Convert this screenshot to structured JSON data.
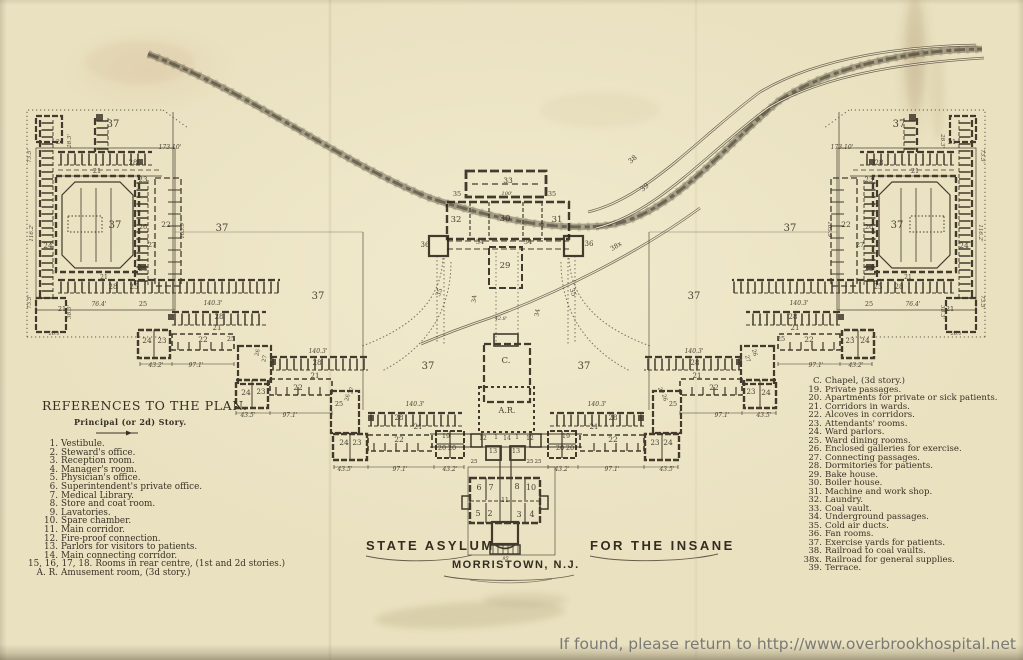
{
  "colors": {
    "paper": "#e9e1c0",
    "ink": "#2b2418",
    "label": "#3a3226",
    "watermark": "#6f6f6f"
  },
  "title_block": {
    "left": "STATE ASYLUM",
    "right": "FOR THE INSANE",
    "city": "MORRISTOWN, N.J."
  },
  "references": {
    "heading": "REFERENCES TO THE PLAN.",
    "subheading": "Principal (or 2d) Story.",
    "left_items": [
      {
        "n": "1.",
        "t": "Vestibule."
      },
      {
        "n": "2.",
        "t": "Steward's office."
      },
      {
        "n": "3.",
        "t": "Reception room."
      },
      {
        "n": "4.",
        "t": "Manager's room."
      },
      {
        "n": "5.",
        "t": "Physician's office."
      },
      {
        "n": "6.",
        "t": "Superintendent's private office."
      },
      {
        "n": "7.",
        "t": "Medical Library."
      },
      {
        "n": "8.",
        "t": "Store and coat room."
      },
      {
        "n": "9.",
        "t": "Lavatories."
      },
      {
        "n": "10.",
        "t": "Spare chamber."
      },
      {
        "n": "11.",
        "t": "Main corridor."
      },
      {
        "n": "12.",
        "t": "Fire-proof connection."
      },
      {
        "n": "13.",
        "t": "Parlors for visitors to patients."
      },
      {
        "n": "14.",
        "t": "Main connecting corridor."
      },
      {
        "n": "15, 16, 17, 18.",
        "t": "Rooms in rear centre, (1st and 2d stories.)"
      },
      {
        "n": "A. R.",
        "t": "Amusement room, (3d story.)"
      }
    ],
    "right_items": [
      {
        "n": "C.",
        "t": "Chapel, (3d story.)"
      },
      {
        "n": "19.",
        "t": "Private passages."
      },
      {
        "n": "20.",
        "t": "Apartments for private or sick patients."
      },
      {
        "n": "21.",
        "t": "Corridors in wards."
      },
      {
        "n": "22.",
        "t": "Alcoves in corridors."
      },
      {
        "n": "23.",
        "t": "Attendants' rooms."
      },
      {
        "n": "24.",
        "t": "Ward parlors."
      },
      {
        "n": "25.",
        "t": "Ward dining rooms."
      },
      {
        "n": "26.",
        "t": "Enclosed galleries for exercise."
      },
      {
        "n": "27.",
        "t": "Connecting passages."
      },
      {
        "n": "28.",
        "t": "Dormitories for patients."
      },
      {
        "n": "29.",
        "t": "Bake house."
      },
      {
        "n": "30.",
        "t": "Boiler house."
      },
      {
        "n": "31.",
        "t": "Machine and work shop."
      },
      {
        "n": "32.",
        "t": "Laundry."
      },
      {
        "n": "33.",
        "t": "Coal vault."
      },
      {
        "n": "34.",
        "t": "Underground passages."
      },
      {
        "n": "35.",
        "t": "Cold air ducts."
      },
      {
        "n": "36.",
        "t": "Fan rooms."
      },
      {
        "n": "37.",
        "t": "Exercise yards for patients."
      },
      {
        "n": "38.",
        "t": "Railroad to coal vaults."
      },
      {
        "n": "38x.",
        "t": "Railroad for general supplies."
      },
      {
        "n": "39.",
        "t": "Terrace."
      }
    ]
  },
  "watermark": "If found, please return to http://www.overbrookhospital.net",
  "plan_labels": [
    {
      "t": "37",
      "x": 113,
      "y": 127,
      "s": 10,
      "m": 1
    },
    {
      "t": "37",
      "x": 115,
      "y": 228,
      "s": 10,
      "m": 1
    },
    {
      "t": "37",
      "x": 222,
      "y": 231,
      "s": 10,
      "m": 1
    },
    {
      "t": "37",
      "x": 318,
      "y": 299,
      "s": 10,
      "m": 1
    },
    {
      "t": "37",
      "x": 428,
      "y": 369,
      "s": 10,
      "m": 1
    },
    {
      "t": "173.10'",
      "x": 170,
      "y": 149,
      "s": 6,
      "m": 1
    },
    {
      "t": "28.3'",
      "x": 71,
      "y": 141,
      "s": 5.5,
      "r": -90,
      "m": 1
    },
    {
      "t": "21",
      "x": 60,
      "y": 144,
      "s": 6.5,
      "m": 1
    },
    {
      "t": "28",
      "x": 133,
      "y": 165,
      "s": 7,
      "m": 1
    },
    {
      "t": "21",
      "x": 97,
      "y": 173,
      "s": 6.5,
      "m": 1
    },
    {
      "t": "23",
      "x": 143,
      "y": 182,
      "s": 7,
      "m": 1
    },
    {
      "t": "26",
      "x": 143,
      "y": 229,
      "s": 6.5,
      "m": 1
    },
    {
      "t": "22",
      "x": 166,
      "y": 227,
      "s": 7.5,
      "m": 1
    },
    {
      "t": "27",
      "x": 152,
      "y": 247,
      "s": 6.5,
      "m": 1
    },
    {
      "t": "23",
      "x": 143,
      "y": 271,
      "s": 7,
      "m": 1
    },
    {
      "t": "24",
      "x": 48,
      "y": 248,
      "s": 7.5,
      "m": 1
    },
    {
      "t": "21",
      "x": 104,
      "y": 279,
      "s": 6,
      "m": 1
    },
    {
      "t": "28",
      "x": 113,
      "y": 289,
      "s": 7,
      "m": 1
    },
    {
      "t": "25",
      "x": 134,
      "y": 289,
      "s": 7,
      "m": 1
    },
    {
      "t": "21",
      "x": 62,
      "y": 311,
      "s": 6.5,
      "m": 1
    },
    {
      "t": "73.5'",
      "x": 31,
      "y": 156,
      "s": 5.5,
      "r": -90,
      "m": 1
    },
    {
      "t": "116.2'",
      "x": 33,
      "y": 233,
      "s": 5.5,
      "r": -90,
      "m": 1
    },
    {
      "t": "73.5'",
      "x": 31,
      "y": 302,
      "s": 5.5,
      "r": -90,
      "m": 1
    },
    {
      "t": "105.9'",
      "x": 184,
      "y": 230,
      "s": 5.5,
      "r": -90,
      "m": 1
    },
    {
      "t": "38.3'",
      "x": 71,
      "y": 312,
      "s": 5.5,
      "r": -90,
      "m": 1
    },
    {
      "t": "76.4'",
      "x": 99,
      "y": 306,
      "s": 6,
      "m": 1
    },
    {
      "t": "26.1'",
      "x": 55,
      "y": 335,
      "s": 5,
      "m": 1
    },
    {
      "t": "25",
      "x": 143,
      "y": 306,
      "s": 6.5,
      "m": 1
    },
    {
      "t": "140.3'",
      "x": 213,
      "y": 305,
      "s": 6,
      "m": 1
    },
    {
      "t": "28",
      "x": 219,
      "y": 319,
      "s": 7,
      "m": 1
    },
    {
      "t": "21",
      "x": 217,
      "y": 330,
      "s": 7,
      "m": 1
    },
    {
      "t": "24",
      "x": 147,
      "y": 343,
      "s": 7.5,
      "m": 1
    },
    {
      "t": "23",
      "x": 162,
      "y": 343,
      "s": 7,
      "m": 1
    },
    {
      "t": "22",
      "x": 203,
      "y": 342,
      "s": 7.5,
      "m": 1
    },
    {
      "t": "25",
      "x": 231,
      "y": 341,
      "s": 6.5,
      "m": 1
    },
    {
      "t": "43.2'",
      "x": 156,
      "y": 367,
      "s": 6,
      "m": 1
    },
    {
      "t": "97.1'",
      "x": 196,
      "y": 367,
      "s": 6,
      "m": 1
    },
    {
      "t": "26",
      "x": 259,
      "y": 353,
      "s": 5.5,
      "r": -75,
      "m": 1
    },
    {
      "t": "27",
      "x": 266,
      "y": 359,
      "s": 5.5,
      "r": -75,
      "m": 1
    },
    {
      "t": "140.3'",
      "x": 318,
      "y": 353,
      "s": 6,
      "m": 1
    },
    {
      "t": "28",
      "x": 317,
      "y": 365,
      "s": 7,
      "m": 1
    },
    {
      "t": "21",
      "x": 315,
      "y": 378,
      "s": 7,
      "m": 1
    },
    {
      "t": "24",
      "x": 246,
      "y": 395,
      "s": 7.5,
      "m": 1
    },
    {
      "t": "23",
      "x": 261,
      "y": 394,
      "s": 7,
      "m": 1
    },
    {
      "t": "22",
      "x": 298,
      "y": 390,
      "s": 7.5,
      "m": 1
    },
    {
      "t": "43.5'",
      "x": 248,
      "y": 417,
      "s": 6,
      "m": 1
    },
    {
      "t": "97.1'",
      "x": 290,
      "y": 417,
      "s": 6,
      "m": 1
    },
    {
      "t": "25",
      "x": 339,
      "y": 406,
      "s": 6.5,
      "m": 1
    },
    {
      "t": "26",
      "x": 349,
      "y": 398,
      "s": 5.5,
      "r": -75,
      "m": 1
    },
    {
      "t": "27",
      "x": 353,
      "y": 391,
      "s": 5.5,
      "r": -75,
      "m": 1
    },
    {
      "t": "140.3'",
      "x": 415,
      "y": 406,
      "s": 6,
      "m": 1
    },
    {
      "t": "28",
      "x": 399,
      "y": 420,
      "s": 7,
      "m": 1
    },
    {
      "t": "21",
      "x": 418,
      "y": 429,
      "s": 7,
      "m": 1
    },
    {
      "t": "24",
      "x": 344,
      "y": 445,
      "s": 7.5,
      "m": 1
    },
    {
      "t": "23",
      "x": 357,
      "y": 445,
      "s": 7,
      "m": 1
    },
    {
      "t": "22",
      "x": 399,
      "y": 442,
      "s": 7.5,
      "m": 1
    },
    {
      "t": "19",
      "x": 446,
      "y": 438,
      "s": 6.5,
      "m": 1
    },
    {
      "t": "20",
      "x": 442,
      "y": 450,
      "s": 6.5,
      "m": 1
    },
    {
      "t": "20",
      "x": 452,
      "y": 450,
      "s": 6.5,
      "m": 1
    },
    {
      "t": "25",
      "x": 474,
      "y": 463,
      "s": 5.5,
      "m": 1
    },
    {
      "t": "43.5'",
      "x": 345,
      "y": 471,
      "s": 6,
      "m": 1
    },
    {
      "t": "97.1'",
      "x": 400,
      "y": 471,
      "s": 6,
      "m": 1
    },
    {
      "t": "43.2'",
      "x": 450,
      "y": 471,
      "s": 6,
      "m": 1
    },
    {
      "t": "35",
      "x": 441,
      "y": 293,
      "s": 6.5,
      "r": -70,
      "m": 1
    },
    {
      "t": "33",
      "x": 508,
      "y": 183,
      "s": 7.5
    },
    {
      "t": "100'",
      "x": 507,
      "y": 195,
      "s": 5
    },
    {
      "t": "35",
      "x": 457,
      "y": 196,
      "s": 6.5
    },
    {
      "t": "35",
      "x": 552,
      "y": 196,
      "s": 6.5
    },
    {
      "t": "32",
      "x": 456,
      "y": 222,
      "s": 8.5
    },
    {
      "t": "30",
      "x": 505,
      "y": 221,
      "s": 8.5
    },
    {
      "t": "31",
      "x": 557,
      "y": 222,
      "s": 8.5
    },
    {
      "t": "36",
      "x": 425,
      "y": 247,
      "s": 7
    },
    {
      "t": "36",
      "x": 589,
      "y": 246,
      "s": 7
    },
    {
      "t": "34",
      "x": 480,
      "y": 244,
      "s": 6.5
    },
    {
      "t": "34",
      "x": 528,
      "y": 244,
      "s": 6.5
    },
    {
      "t": "29",
      "x": 505,
      "y": 268,
      "s": 8.5
    },
    {
      "t": "34",
      "x": 476,
      "y": 299,
      "s": 6,
      "r": -85
    },
    {
      "t": "34",
      "x": 539,
      "y": 313,
      "s": 6,
      "r": -80
    },
    {
      "t": "42.8'",
      "x": 501,
      "y": 320,
      "s": 5
    },
    {
      "t": "C.",
      "x": 506,
      "y": 363,
      "s": 8.5
    },
    {
      "t": "A.R.",
      "x": 507,
      "y": 413,
      "s": 8
    },
    {
      "t": "12",
      "x": 483,
      "y": 440,
      "s": 6
    },
    {
      "t": "1",
      "x": 496,
      "y": 439,
      "s": 6
    },
    {
      "t": "14",
      "x": 507,
      "y": 440,
      "s": 6
    },
    {
      "t": "1",
      "x": 517,
      "y": 439,
      "s": 6
    },
    {
      "t": "12",
      "x": 530,
      "y": 440,
      "s": 6
    },
    {
      "t": "13",
      "x": 493,
      "y": 453,
      "s": 6.5
    },
    {
      "t": "13",
      "x": 516,
      "y": 453,
      "s": 6.5
    },
    {
      "t": "25",
      "x": 530,
      "y": 463,
      "s": 5.5
    },
    {
      "t": "6",
      "x": 479,
      "y": 490,
      "s": 8
    },
    {
      "t": "7",
      "x": 491,
      "y": 490,
      "s": 8
    },
    {
      "t": "8",
      "x": 517,
      "y": 489,
      "s": 8
    },
    {
      "t": "10",
      "x": 531,
      "y": 490,
      "s": 8
    },
    {
      "t": "11",
      "x": 505,
      "y": 502,
      "s": 6
    },
    {
      "t": "5",
      "x": 478,
      "y": 516,
      "s": 8
    },
    {
      "t": "2",
      "x": 490,
      "y": 516,
      "s": 8
    },
    {
      "t": "3",
      "x": 519,
      "y": 517,
      "s": 8
    },
    {
      "t": "4",
      "x": 532,
      "y": 517,
      "s": 8
    },
    {
      "t": "95'",
      "x": 506,
      "y": 560,
      "s": 4.5
    },
    {
      "t": "38",
      "x": 634,
      "y": 161,
      "s": 7,
      "r": -40
    },
    {
      "t": "39",
      "x": 646,
      "y": 189,
      "s": 7,
      "r": -40
    },
    {
      "t": "38x",
      "x": 617,
      "y": 248,
      "s": 6.5,
      "r": -32
    }
  ]
}
